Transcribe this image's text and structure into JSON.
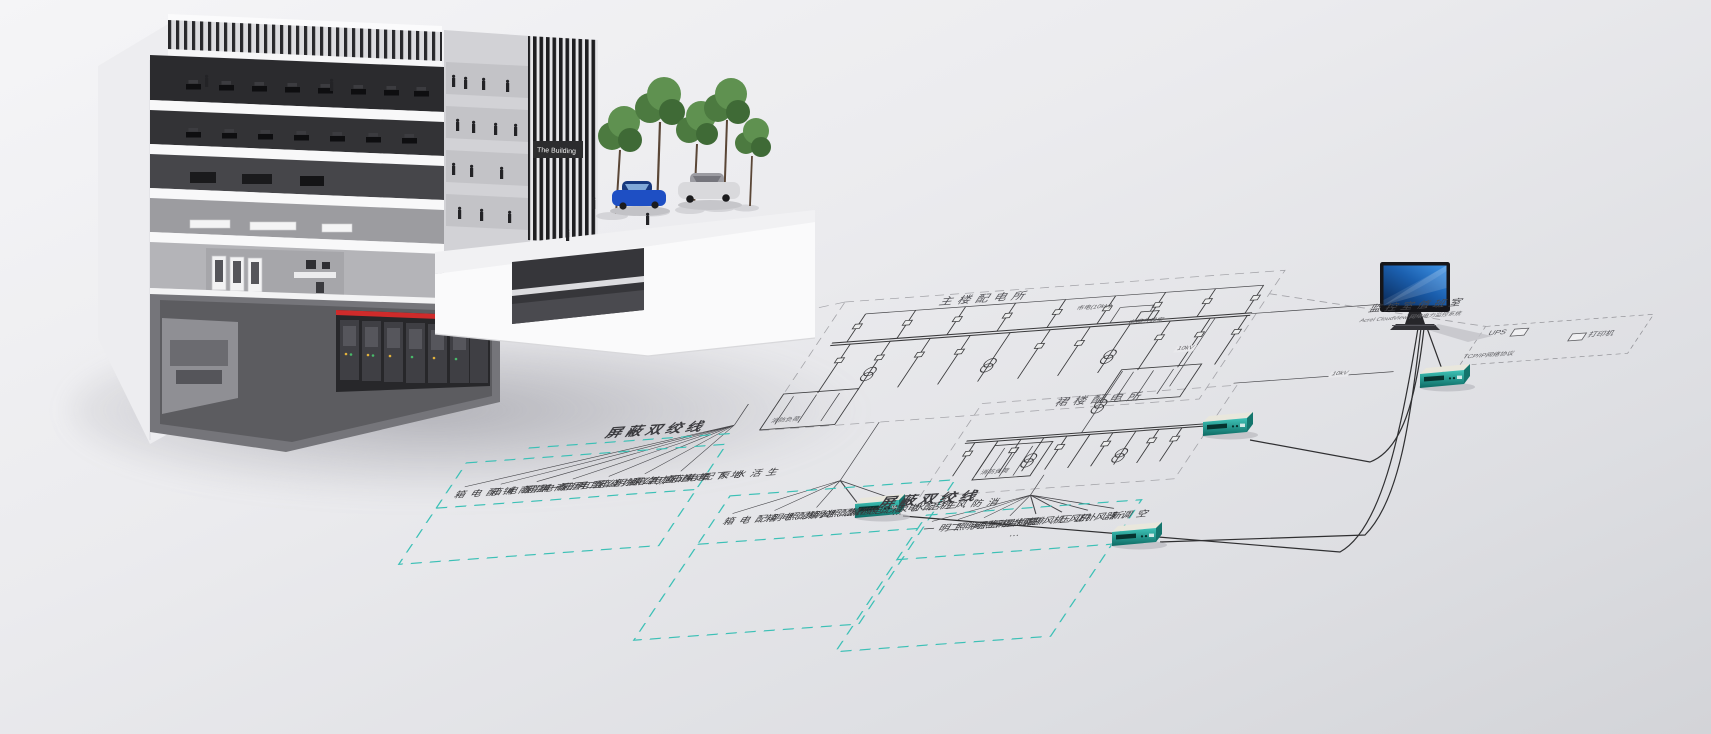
{
  "building": {
    "sign": "The Building"
  },
  "plan": {
    "main_substation": "主楼配电所",
    "podium_substation": "裙楼配电所",
    "twisted_pair_label_1": "屏蔽双绞线",
    "twisted_pair_label_2": "屏蔽双绞线",
    "fire_load_1": "消防负荷",
    "fire_load_2": "消防负荷",
    "utility_incoming": "市电(10kV)",
    "cable_boundary_room": "电缆分界室",
    "voltage_tag_1": "10kV",
    "voltage_tag_2": "10kV",
    "ellipsis": "⋯",
    "monitor_room_title": "监控室值班室",
    "monitor_room_subtitle": "Acrel CloudView 网络电力监控系统",
    "ups_label": "UPS",
    "printer_label": "打印机",
    "protocol_label": "TCP/IP网络协议",
    "gateway_device_count": 4,
    "load_groups": [
      {
        "labels": [
          "一层商铺配电箱",
          "二层商铺配电箱",
          "办公照明配电箱",
          "办公插座配电箱",
          "走道应急照明箱",
          "地下车库配电箱",
          "生活水泵配电箱"
        ]
      },
      {
        "labels": [
          "公共照明配电箱",
          "应急照明配电箱",
          "电梯配电箱",
          "生活水泵配电箱",
          "消防风机配电箱"
        ]
      },
      {
        "labels": [
          "卫生间照明一",
          "卫生间照明二",
          "露台照明",
          "排烟机",
          "正压风机",
          "补风机",
          "新风机",
          "空调器"
        ]
      }
    ],
    "colors": {
      "teal_dashed": "#3cc0b6",
      "diagram_line": "#3a3a3c",
      "boundary_dash": "#a3a3a8",
      "device_body": "#23a59b",
      "monitor_screen": "#2f7fd6",
      "switchgear_red": "#cf2b2b",
      "tree_green": "#558a47",
      "car_blue": "#1e4fc4"
    }
  }
}
